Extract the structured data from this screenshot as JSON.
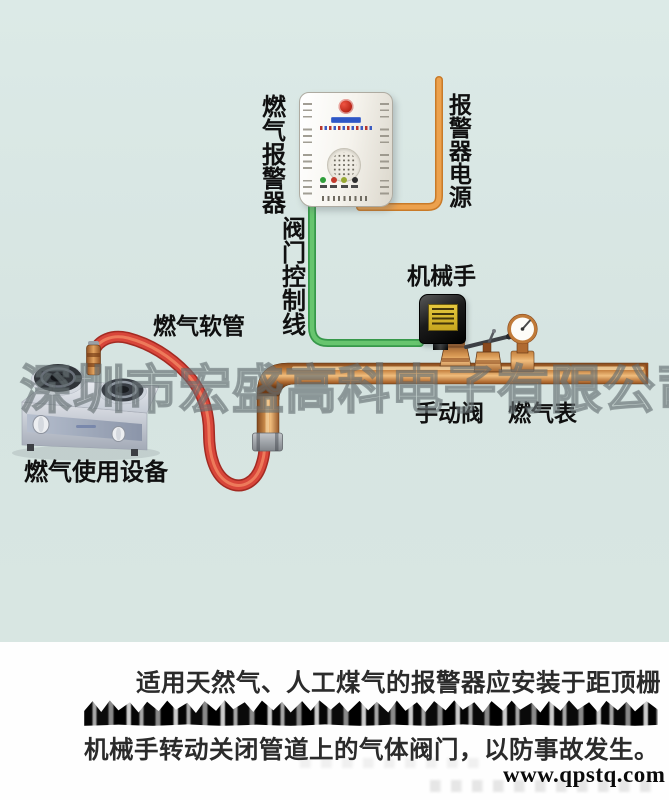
{
  "diagram": {
    "watermark": "深圳市宏盛高科电子有限公司",
    "labels": {
      "alarm_device": "燃气报警器",
      "valve_control_line": "阀门控制线",
      "alarm_power": "报警器电源",
      "manipulator": "机械手",
      "gas_hose": "燃气软管",
      "manual_valve": "手动阀",
      "gas_meter": "燃气表",
      "gas_appliance": "燃气使用设备"
    },
    "colors": {
      "background": "#d8e6e3",
      "power_wire_orange": "#e8963f",
      "control_wire_green": "#57b95e",
      "pipe_copper": "#c07a38",
      "hose_red": "#d8463a"
    }
  },
  "caption": {
    "line1": "适用天然气、人工煤气的报警器应安装于距顶栅",
    "line3": "机械手转动关闭管道上的气体阀门，以防事故发生。",
    "website": "www.qpstq.com"
  }
}
